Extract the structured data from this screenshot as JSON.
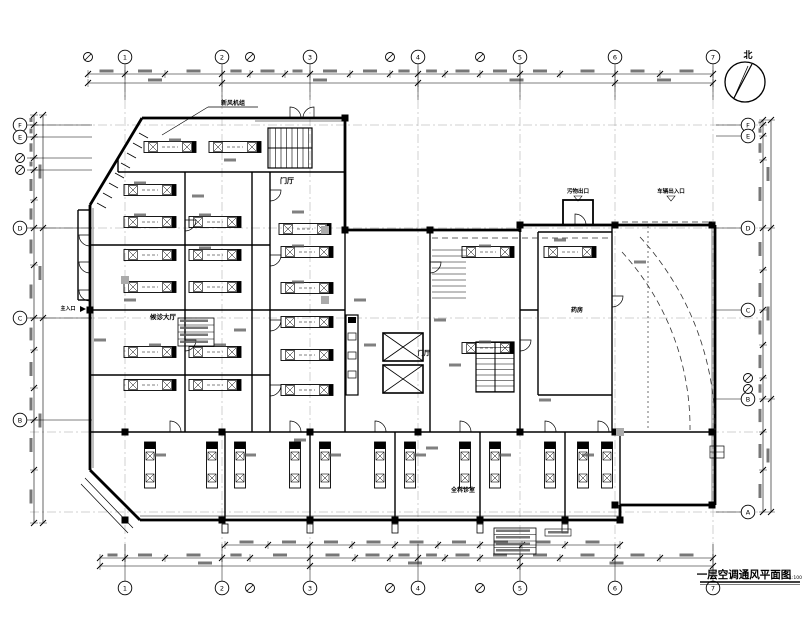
{
  "drawing": {
    "title": "一层空调通风平面图",
    "scale": "1:100",
    "north_label": "北"
  },
  "grid": {
    "top": [
      "1",
      "2",
      "3",
      "4",
      "5",
      "6",
      "7"
    ],
    "bottom": [
      "1",
      "2",
      "3",
      "4",
      "5",
      "6",
      "7"
    ],
    "left": [
      "F",
      "E",
      "D",
      "C",
      "B"
    ],
    "right": [
      "F",
      "E",
      "D",
      "C",
      "B",
      "A"
    ]
  },
  "rooms": [
    {
      "label": "门厅"
    },
    {
      "label": "门厅"
    },
    {
      "label": "候诊大厅"
    },
    {
      "label": "全科诊室"
    },
    {
      "label": "药房"
    }
  ],
  "annotations": [
    {
      "label": "新风机组"
    },
    {
      "label": "污物出口"
    },
    {
      "label": "车辆出入口"
    },
    {
      "label": "主入口"
    }
  ],
  "colors": {
    "line": "#000000",
    "dim_text": "#555555",
    "axis": "#888888"
  }
}
